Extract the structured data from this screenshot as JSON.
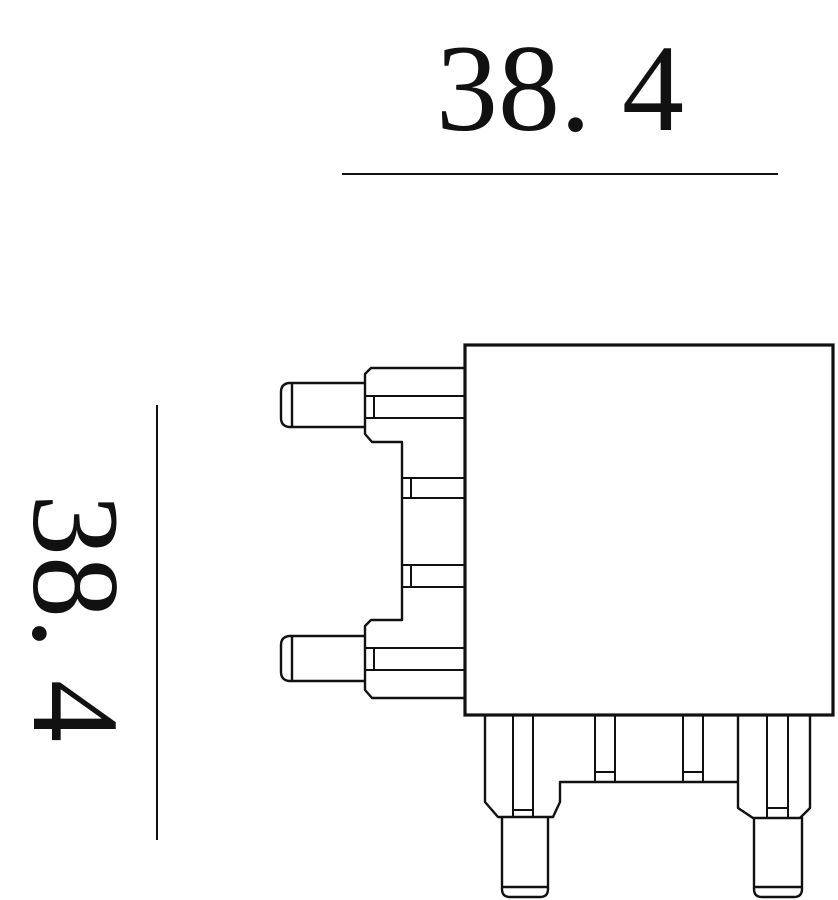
{
  "drawing": {
    "type": "technical-dimension-drawing",
    "top_dimension": {
      "value": "38. 4"
    },
    "left_dimension": {
      "value": "38. 4"
    },
    "colors": {
      "line": "#111111",
      "background": "#ffffff"
    }
  }
}
